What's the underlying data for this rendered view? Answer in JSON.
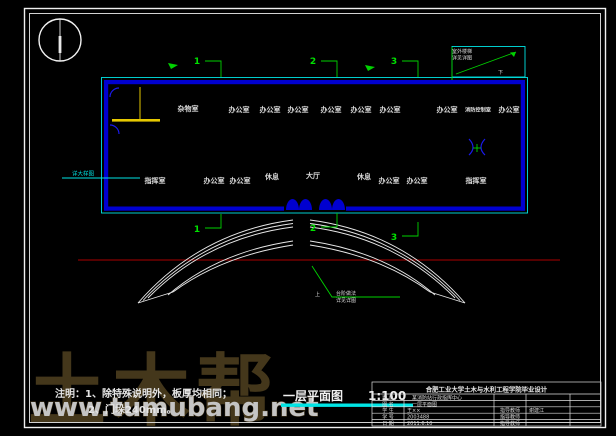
{
  "watermark": {
    "brand": "土木帮",
    "site": "www.tumubang.net"
  },
  "figure": {
    "label": "一层平面图",
    "scale": "1:100"
  },
  "notes": {
    "heading": "注明：",
    "line1": "1、除特殊说明外，板厚均相同；",
    "line2": "2、门垛240mm。"
  },
  "axes": {
    "top": [
      "1",
      "2",
      "3",
      "4",
      "5",
      "6",
      "7",
      "8",
      "9",
      "10",
      "11",
      "12",
      "13",
      "14",
      "15"
    ],
    "bottom": [
      "1",
      "2",
      "3",
      "4",
      "5",
      "6",
      "7",
      "8",
      "9",
      "10",
      "11",
      "12",
      "13",
      "14",
      "15"
    ],
    "left": [
      "E",
      "D",
      "C",
      "B",
      "A"
    ],
    "right": [
      "E",
      "D",
      "C",
      "B"
    ]
  },
  "rooms": [
    {
      "label": "杂物室"
    },
    {
      "label": "办公室"
    },
    {
      "label": "办公室"
    },
    {
      "label": "办公室"
    },
    {
      "label": "办公室"
    },
    {
      "label": "办公室"
    },
    {
      "label": "办公室"
    },
    {
      "label": "办公室"
    },
    {
      "label": "消防控制室"
    },
    {
      "label": "办公室"
    },
    {
      "label": "指挥室"
    },
    {
      "label": "办公室"
    },
    {
      "label": "办公室"
    },
    {
      "label": "休息"
    },
    {
      "label": "大厅"
    },
    {
      "label": "休息"
    },
    {
      "label": "办公室"
    },
    {
      "label": "办公室"
    },
    {
      "label": "指挥室"
    }
  ],
  "sections": {
    "s1": "1",
    "s2": "2",
    "s3": "3"
  },
  "annotations": {
    "stair_down": "下",
    "steps_up": "上",
    "ext_stair_note1": "室外楼梯",
    "ext_stair_note2": "详见详图",
    "steps_note1": "台阶做法",
    "steps_note2": "详见详图",
    "side_note": "详大样图"
  },
  "title_block": {
    "header": "合肥工业大学土木与水利工程学院毕业设计",
    "rows": [
      {
        "label": "题 目",
        "value": "某消防站行政指挥中心",
        "label2": "",
        "value2": ""
      },
      {
        "label": "图 名",
        "value": "一层平面图",
        "label2": "",
        "value2": ""
      },
      {
        "label": "学 生",
        "value": "王××",
        "label2": "指导教师",
        "value2": "谢建江"
      },
      {
        "label": "学 号",
        "value": "2003488",
        "label2": "指导教师",
        "value2": ""
      },
      {
        "label": "日 期",
        "value": "2011.6.10",
        "label2": "指导教师",
        "value2": ""
      }
    ]
  },
  "colors": {
    "grid_green": "#00d200",
    "axis_red": "#aa0000",
    "wall_blue": "#0000d0",
    "detail_cyan": "#00e5e5",
    "partition_yellow": "#e6c800",
    "text_white": "#dcdcdc",
    "plant_green": "#00bb00",
    "watermark_brown": "#483a1d"
  }
}
